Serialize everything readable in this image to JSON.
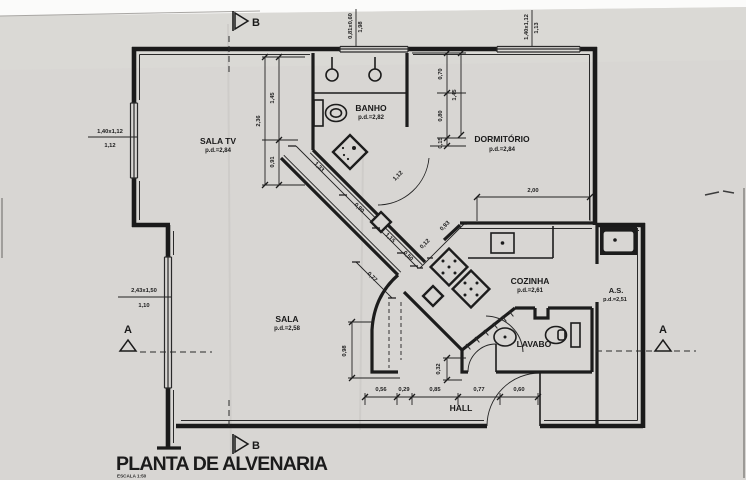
{
  "title": {
    "main": "PLANTA DE ALVENARIA",
    "scale": "ESCALA 1:50"
  },
  "rooms": {
    "sala_tv": {
      "name": "SALA TV",
      "pd": "p.d.=2,84"
    },
    "banho": {
      "name": "BANHO",
      "pd": "p.d.=2,82"
    },
    "dormitorio": {
      "name": "DORMITÓRIO",
      "pd": "p.d.=2,84"
    },
    "cozinha": {
      "name": "COZINHA",
      "pd": "p.d.=2,61"
    },
    "area_servico": {
      "name": "A.S.",
      "pd": "p.d.=2,51"
    },
    "lavabo": {
      "name": "LAVABO"
    },
    "sala": {
      "name": "SALA",
      "pd": "p.d.=2,58"
    },
    "hall": {
      "name": "HALL"
    }
  },
  "windows": {
    "sala_tv_left": {
      "size": "1,40x1,12",
      "sill": "1,12"
    },
    "sala_left": {
      "size": "2,43x1,50",
      "sill": "1,10"
    },
    "banho_top": {
      "size": "0,81x0,60",
      "sill": "1,98"
    },
    "dormitorio_top": {
      "size": "1,40x1,12",
      "sill": "1,13"
    }
  },
  "dims": {
    "salatv_total": "2,36",
    "salatv_a": "1,45",
    "salatv_b": "0,91",
    "dorm_a": "0,70",
    "dorm_b": "0,80",
    "dorm_c": "0,15",
    "dorm_total": "1,45",
    "dorm_width": "2,00",
    "diag_a": "1,33",
    "diag_b": "0,90",
    "diag_c": "1,15",
    "diag_d": "0,50",
    "door_banho": "1,12",
    "cross_a": "0,12",
    "cross_b": "0,93",
    "diag_e": "0,77",
    "hall_left_h": "0,98",
    "lavabo_stub": "0,32",
    "hall_chain": [
      "0,56",
      "0,29",
      "0,85",
      "0,77",
      "0,60"
    ]
  },
  "markers": {
    "a": "A",
    "b": "B"
  }
}
